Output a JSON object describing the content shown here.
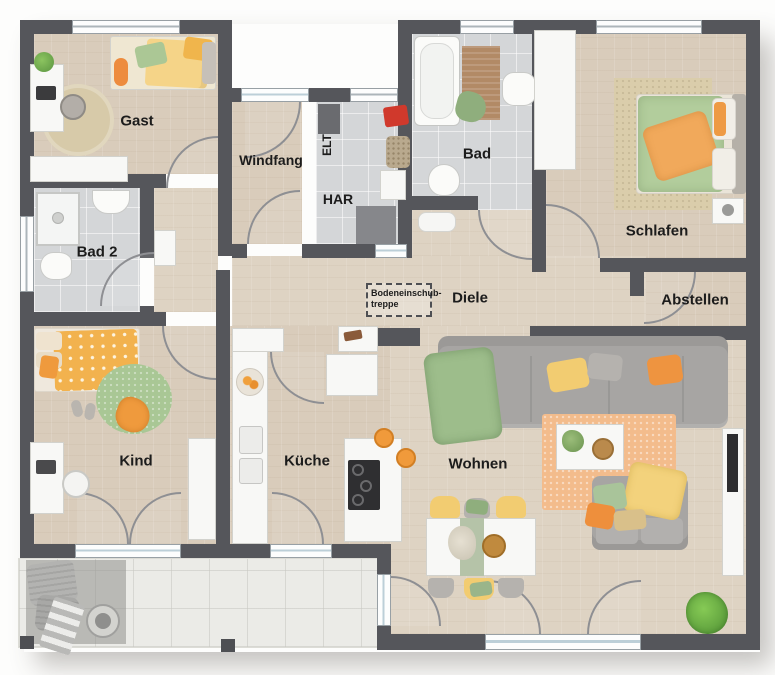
{
  "plan": {
    "labels": {
      "gast": "Gast",
      "windfang": "Windfang",
      "elt": "ELT",
      "har": "HAR",
      "bad": "Bad",
      "schlafen": "Schlafen",
      "bad2": "Bad 2",
      "diele": "Diele",
      "abstellen": "Abstellen",
      "attic_line1": "Bodeneinschub-",
      "attic_line2": "treppe",
      "kind": "Kind",
      "kueche": "Küche",
      "wohnen": "Wohnen"
    },
    "colors": {
      "wall": "#55565b",
      "wood_floor": "#d9ccbb",
      "tile_floor": "#d4d6d8",
      "terrace_floor": "#ebebe7",
      "accent_orange": "#ef9a3d",
      "accent_yellow": "#f2cc71",
      "accent_green": "#a9c795",
      "sofa_gray": "#a7a5a3",
      "toolbox_red": "#d0392c",
      "label_text": "#1c1c1c"
    }
  }
}
